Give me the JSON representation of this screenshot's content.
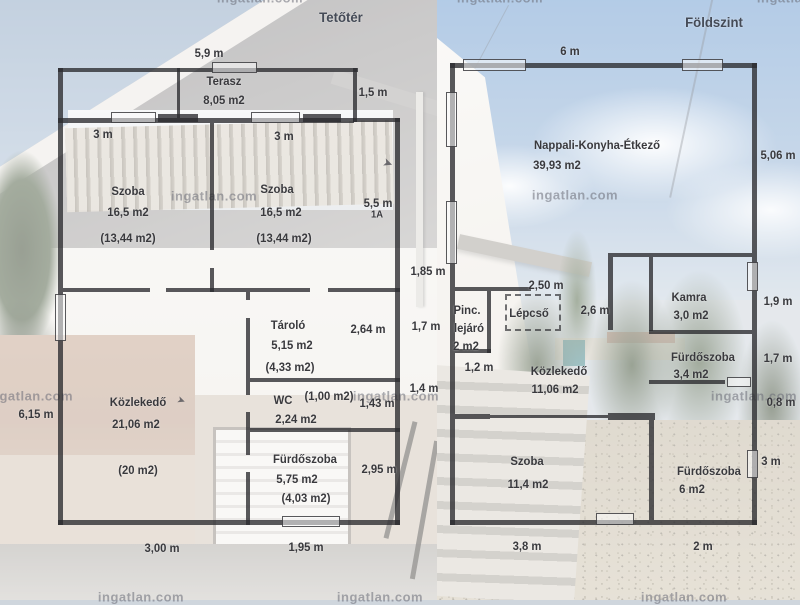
{
  "page": {
    "title_left": "Tetőtér",
    "title_right": "Földszint"
  },
  "watermark": {
    "text": "ingatlan.com"
  },
  "attic": {
    "rooms": {
      "terasz": {
        "name": "Terasz",
        "area": "8,05 m2"
      },
      "szoba_left": {
        "name": "Szoba",
        "area": "16,5 m2",
        "net": "(13,44 m2)"
      },
      "szoba_right": {
        "name": "Szoba",
        "area": "16,5 m2",
        "net": "(13,44 m2)"
      },
      "tarolo": {
        "name": "Tároló",
        "area": "5,15 m2",
        "net": "(4,33 m2)"
      },
      "wc": {
        "name": "WC",
        "area": "2,24 m2",
        "net": "(1,00 m2)"
      },
      "kozlekedo": {
        "name": "Közlekedő",
        "area": "21,06 m2",
        "net": "(20 m2)"
      },
      "furdoszoba": {
        "name": "Fürdőszoba",
        "area": "5,75 m2",
        "net": "(4,03 m2)"
      }
    },
    "dims": {
      "top": "5,9 m",
      "szoba_left_w": "3 m",
      "szoba_right_w": "3 m",
      "notch": "1,5 m",
      "right_szoba": "5,5 m",
      "stair_mark": "1A",
      "tarolo_h": "2,64 m",
      "wc_h": "1,43 m",
      "furdo_h": "2,95 m",
      "left_h": "6,15 m",
      "bottom_kozlekedo": "3,00 m",
      "bottom_furdo": "1,95 m"
    }
  },
  "ground": {
    "rooms": {
      "nappali": {
        "name": "Nappali-Konyha-Étkező",
        "area": "39,93 m2"
      },
      "pinc": {
        "line1": "Pinc.",
        "line2": "lejáró",
        "area": "2 m2"
      },
      "lepcso": {
        "name": "Lépcső"
      },
      "kamra": {
        "name": "Kamra",
        "area": "3,0 m2"
      },
      "kozlekedo": {
        "name": "Közlekedő",
        "area": "11,06 m2"
      },
      "furdoszoba1": {
        "name": "Fürdőszoba",
        "area": "3,4 m2"
      },
      "szoba": {
        "name": "Szoba",
        "area": "11,4 m2"
      },
      "furdoszoba2": {
        "name": "Fürdőszoba",
        "area": "6 m2"
      }
    },
    "dims": {
      "top": "6 m",
      "right": "5,06 m",
      "left_1": "1,85 m",
      "left_2": "1,7 m",
      "left_3": "1,4 m",
      "lepcso_top": "2,50 m",
      "lepcso_right": "2,6 m",
      "pinc_w": "1,2 m",
      "kamra_h": "1,9 m",
      "furdo1_h": "1,7 m",
      "wall_seg": "0,8 m",
      "furdo2_door": "3 m",
      "bottom_szoba": "3,8 m",
      "bottom_furdo": "2 m"
    }
  }
}
